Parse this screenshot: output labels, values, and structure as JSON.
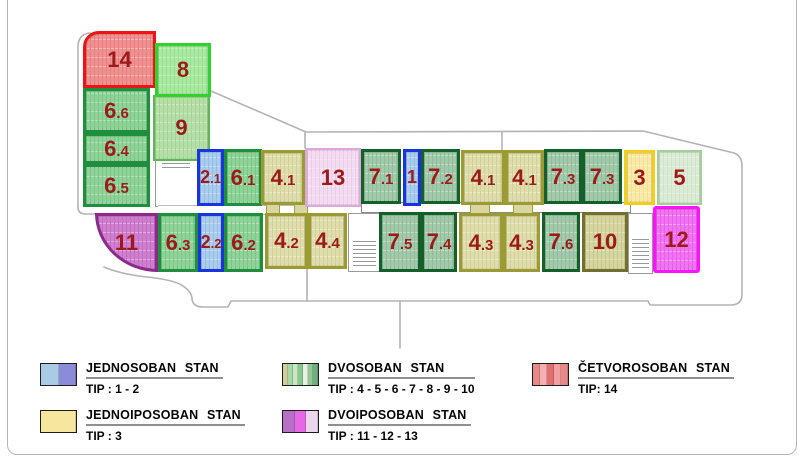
{
  "page": {
    "background": "#ffffff",
    "frame_color": "#b5b5b5",
    "outline_color": "#b3b3b3"
  },
  "number_color": "#9c1a1a",
  "unit_types": {
    "blue": {
      "fill": "#aacdee",
      "stripe": "#95bde4",
      "border": "#1734df",
      "border_width": 3
    },
    "green6": {
      "fill": "#8ed398",
      "stripe": "#7cc488",
      "border": "#1d8f3d",
      "border_width": 3
    },
    "olive4": {
      "fill": "#deddab",
      "stripe": "#d2d198",
      "border": "#9c9b31",
      "border_width": 3
    },
    "sage7": {
      "fill": "#a3c9ab",
      "stripe": "#8fbc9a",
      "border": "#14602b",
      "border_width": 3.5
    },
    "yellow3": {
      "fill": "#f8eaa6",
      "stripe": "#f2e190",
      "border": "#f2cf1c",
      "border_width": 3
    },
    "palegreen5": {
      "fill": "#dcead6",
      "stripe": "#d0e2c8",
      "border": "#a6cf9e",
      "border_width": 2.5
    },
    "pink13": {
      "fill": "#f3dbf0",
      "stripe": "#ecccea",
      "border": "#dfa8dc",
      "border_width": 2.5
    },
    "green8": {
      "fill": "#a8e8a0",
      "stripe": "#97e08e",
      "border": "#2ed32e",
      "border_width": 3.5
    },
    "green9": {
      "fill": "#b4dfa6",
      "stripe": "#a6d597",
      "border": "#5cb854",
      "border_width": 2.5
    },
    "olive10": {
      "fill": "#d5d5a0",
      "stripe": "#c8c88e",
      "border": "#72702c",
      "border_width": 3.5
    },
    "purple11": {
      "fill": "#ce7fce",
      "stripe": "#c26cc2",
      "border": "#8c2a8c",
      "border_width": 3.5
    },
    "magenta12": {
      "fill": "#f273f2",
      "stripe": "#ea5fea",
      "border": "#ff10ff",
      "border_width": 3
    },
    "red14": {
      "fill": "#f09191",
      "stripe": "#e87f7f",
      "border": "#ee1414",
      "border_width": 3.5
    }
  },
  "units": [
    {
      "label": "14",
      "type": "red14",
      "x": 83,
      "y": 31,
      "w": 73,
      "h": 57,
      "shape": "round-tl"
    },
    {
      "label": "9",
      "type": "green9",
      "x": 153,
      "y": 95,
      "w": 57,
      "h": 66
    },
    {
      "label": "8",
      "type": "green8",
      "x": 155,
      "y": 43,
      "w": 56,
      "h": 54
    },
    {
      "label": "6.6",
      "type": "green6",
      "x": 83,
      "y": 88,
      "w": 67,
      "h": 45
    },
    {
      "label": "6.4",
      "type": "green6",
      "x": 83,
      "y": 133,
      "w": 67,
      "h": 31
    },
    {
      "label": "6.5",
      "type": "green6",
      "x": 83,
      "y": 164,
      "w": 67,
      "h": 43
    },
    {
      "label": "2.1",
      "type": "blue",
      "x": 197,
      "y": 149,
      "w": 27,
      "h": 57
    },
    {
      "label": "6.1",
      "type": "green6",
      "x": 224,
      "y": 149,
      "w": 38,
      "h": 57
    },
    {
      "label": "4.1",
      "type": "olive4",
      "x": 261,
      "y": 150,
      "w": 44,
      "h": 55
    },
    {
      "label": "13",
      "type": "pink13",
      "x": 305,
      "y": 148,
      "w": 56,
      "h": 59
    },
    {
      "label": "7.1",
      "type": "sage7",
      "x": 361,
      "y": 149,
      "w": 40,
      "h": 55
    },
    {
      "label": "1",
      "type": "blue",
      "x": 403,
      "y": 149,
      "w": 18,
      "h": 57
    },
    {
      "label": "7.2",
      "type": "sage7",
      "x": 421,
      "y": 149,
      "w": 39,
      "h": 55
    },
    {
      "label": "4.1",
      "type": "olive4",
      "x": 461,
      "y": 150,
      "w": 44,
      "h": 55
    },
    {
      "label": "4.1",
      "type": "olive4",
      "x": 505,
      "y": 150,
      "w": 39,
      "h": 55
    },
    {
      "label": "7.3",
      "type": "sage7",
      "x": 544,
      "y": 149,
      "w": 38,
      "h": 55
    },
    {
      "label": "7.3",
      "type": "sage7",
      "x": 582,
      "y": 149,
      "w": 40,
      "h": 55
    },
    {
      "label": "3",
      "type": "yellow3",
      "x": 624,
      "y": 150,
      "w": 31,
      "h": 55
    },
    {
      "label": "5",
      "type": "palegreen5",
      "x": 657,
      "y": 150,
      "w": 45,
      "h": 55
    },
    {
      "label": "11",
      "type": "purple11",
      "x": 95,
      "y": 213,
      "w": 63,
      "h": 59,
      "shape": "wedge"
    },
    {
      "label": "6.3",
      "type": "green6",
      "x": 158,
      "y": 213,
      "w": 40,
      "h": 59
    },
    {
      "label": "2.2",
      "type": "blue",
      "x": 198,
      "y": 213,
      "w": 26,
      "h": 59
    },
    {
      "label": "6.2",
      "type": "green6",
      "x": 224,
      "y": 213,
      "w": 39,
      "h": 59
    },
    {
      "label": "4.2",
      "type": "olive4",
      "x": 265,
      "y": 213,
      "w": 43,
      "h": 56
    },
    {
      "label": "4.4",
      "type": "olive4",
      "x": 308,
      "y": 213,
      "w": 39,
      "h": 56
    },
    {
      "label": "7.5",
      "type": "sage7",
      "x": 379,
      "y": 212,
      "w": 42,
      "h": 60
    },
    {
      "label": "7.4",
      "type": "sage7",
      "x": 421,
      "y": 212,
      "w": 36,
      "h": 60
    },
    {
      "label": "4.3",
      "type": "olive4",
      "x": 459,
      "y": 213,
      "w": 44,
      "h": 59
    },
    {
      "label": "4.3",
      "type": "olive4",
      "x": 503,
      "y": 213,
      "w": 37,
      "h": 59
    },
    {
      "label": "7.6",
      "type": "sage7",
      "x": 542,
      "y": 212,
      "w": 38,
      "h": 60
    },
    {
      "label": "10",
      "type": "olive10",
      "x": 582,
      "y": 212,
      "w": 46,
      "h": 60
    },
    {
      "label": "12",
      "type": "magenta12",
      "x": 653,
      "y": 206,
      "w": 47,
      "h": 67,
      "shape": "r12"
    }
  ],
  "legend": {
    "items": [
      {
        "title": "JEDNOSOBAN STAN",
        "tip": "TIP : 1 - 2",
        "swatch": [
          "#a9cbe6",
          "#8b8bd9"
        ]
      },
      {
        "title": "JEDNOIPOSOBAN STAN",
        "tip": "TIP : 3",
        "swatch": [
          "#f5e79e"
        ]
      },
      {
        "title": "DVOSOBAN STAN",
        "tip": "TIP : 4 - 5 - 6 - 7 - 8 - 9 - 10",
        "swatch": [
          "#cfcf9c",
          "#a8d8a8",
          "#c8e8c0",
          "#86c890",
          "#e8f0e0",
          "#90c898",
          "#6fae7e"
        ]
      },
      {
        "title": "DVOIPOSOBAN STAN",
        "tip": "TIP : 11 - 12 - 13",
        "swatch": [
          "#b670c6",
          "#e668e6",
          "#ecd6ec"
        ]
      },
      {
        "title": "ČETVOROSOBAN STAN",
        "tip": "TIP: 14",
        "swatch": [
          "#e88888",
          "#f2b0b0",
          "#e07070",
          "#f0a0a0",
          "#e88888"
        ]
      }
    ]
  }
}
